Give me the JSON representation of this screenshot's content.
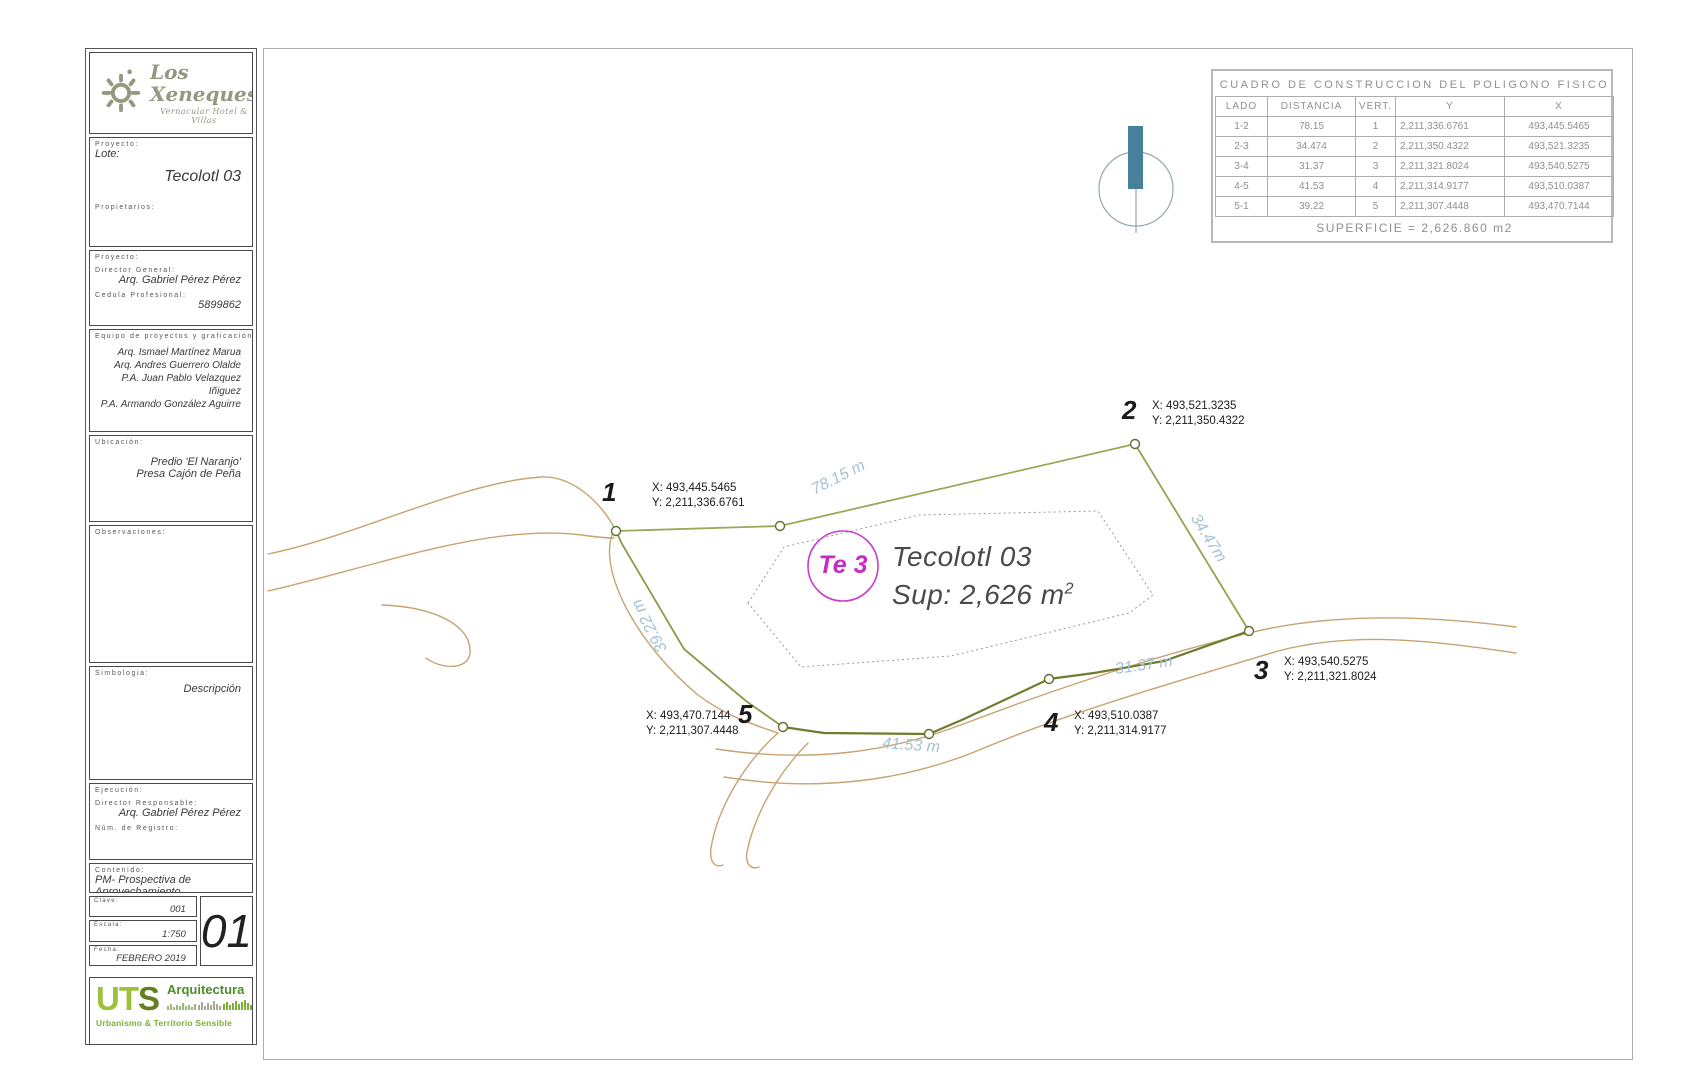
{
  "sidebar": {
    "logo": {
      "brand": "Los Xeneques",
      "tagline": "Vernacular Hotel & Villas"
    },
    "lote": {
      "label_proyecto": "Proyecto:",
      "label_lote": "Lote:",
      "value": "Tecolotl 03",
      "label_propietarios": "Propietarios:"
    },
    "proyecto": {
      "label": "Proyecto:",
      "director_label": "Director General:",
      "director": "Arq. Gabriel Pérez Pérez",
      "cedula_label": "Cedula Profesional:",
      "cedula": "5899862"
    },
    "equipo": {
      "label": "Equipo de proyectos y graficación:",
      "members": [
        "Arq. Ismael Martínez Marua",
        "Arq. Andres Guerrero Olalde",
        "P.A. Juan Pablo Velazquez Iñiguez",
        "P.A. Armando González Aguirre"
      ]
    },
    "ubicacion": {
      "label": "Ubicación:",
      "lines": [
        "Predio 'El Naranjo'",
        "Presa Cajón de Peña"
      ]
    },
    "observaciones": {
      "label": "Observaciones:"
    },
    "simbologia": {
      "label": "Simbologia:",
      "descripcion": "Descripción"
    },
    "ejecucion": {
      "label": "Ejecución:",
      "responsable_label": "Director Responsable:",
      "responsable": "Arq. Gabriel Pérez Pérez",
      "registro_label": "Núm. de Registro:"
    },
    "contenido": {
      "label": "Contenido:",
      "value": "PM- Prospectiva de Aprovechamiento"
    },
    "clave": {
      "label": "Clave:",
      "value": "001"
    },
    "escala": {
      "label": "Escala:",
      "value": "1:750"
    },
    "fecha": {
      "label": "Fecha:",
      "value": "FEBRERO 2019"
    },
    "sheet_number": "01",
    "uts": {
      "ut": "UT",
      "s": "S",
      "line1": "Arquitectura",
      "line2": "Urbanismo & Territorio Sensible"
    }
  },
  "table": {
    "title": "CUADRO DE CONSTRUCCION DEL POLIGONO FISICO",
    "headers": [
      "LADO",
      "DISTANCIA",
      "VERT.",
      "Y",
      "X"
    ],
    "rows": [
      [
        "1-2",
        "78.15",
        "1",
        "2,211,336.6761",
        "493,445.5465"
      ],
      [
        "2-3",
        "34.474",
        "2",
        "2,211,350.4322",
        "493,521.3235"
      ],
      [
        "3-4",
        "31.37",
        "3",
        "2,211,321.8024",
        "493,540.5275"
      ],
      [
        "4-5",
        "41.53",
        "4",
        "2,211,314.9177",
        "493,510.0387"
      ],
      [
        "5-1",
        "39.22",
        "5",
        "2,211,307.4448",
        "493,470.7144"
      ]
    ],
    "footer": "SUPERFICIE = 2,626.860 m2"
  },
  "plot": {
    "parcel_tag": "Te 3",
    "title": "Tecolotl 03",
    "area_label": "Sup: 2,626 m",
    "area_sup": "2",
    "vertices": [
      {
        "num": "1",
        "x": "X: 493,445.5465",
        "y": "Y: 2,211,336.6761"
      },
      {
        "num": "2",
        "x": "X: 493,521.3235",
        "y": "Y: 2,211,350.4322"
      },
      {
        "num": "3",
        "x": "X: 493,540.5275",
        "y": "Y: 2,211,321.8024"
      },
      {
        "num": "4",
        "x": "X: 493,510.0387",
        "y": "Y: 2,211,314.9177"
      },
      {
        "num": "5",
        "x": "X: 493,470.7144",
        "y": "Y: 2,211,307.4448"
      }
    ],
    "distances": {
      "d12": "78.15 m",
      "d23": "34.47m",
      "d34": "31.37 m",
      "d45": "41.53 m",
      "d51": "39.22 m"
    }
  },
  "colors": {
    "polygon_green": "#8a9a4a",
    "polygon_dark_green": "#6f7c2d",
    "road_tan": "#c7a372",
    "distance_blue": "#a3c2d6",
    "parcel_magenta": "#c62bc6",
    "compass_teal": "#47809b",
    "logo_gray": "#97977f",
    "uts_green": "#9cc13c",
    "uts_dark_green": "#647f1f",
    "uts_purple": "#7a68ad"
  }
}
